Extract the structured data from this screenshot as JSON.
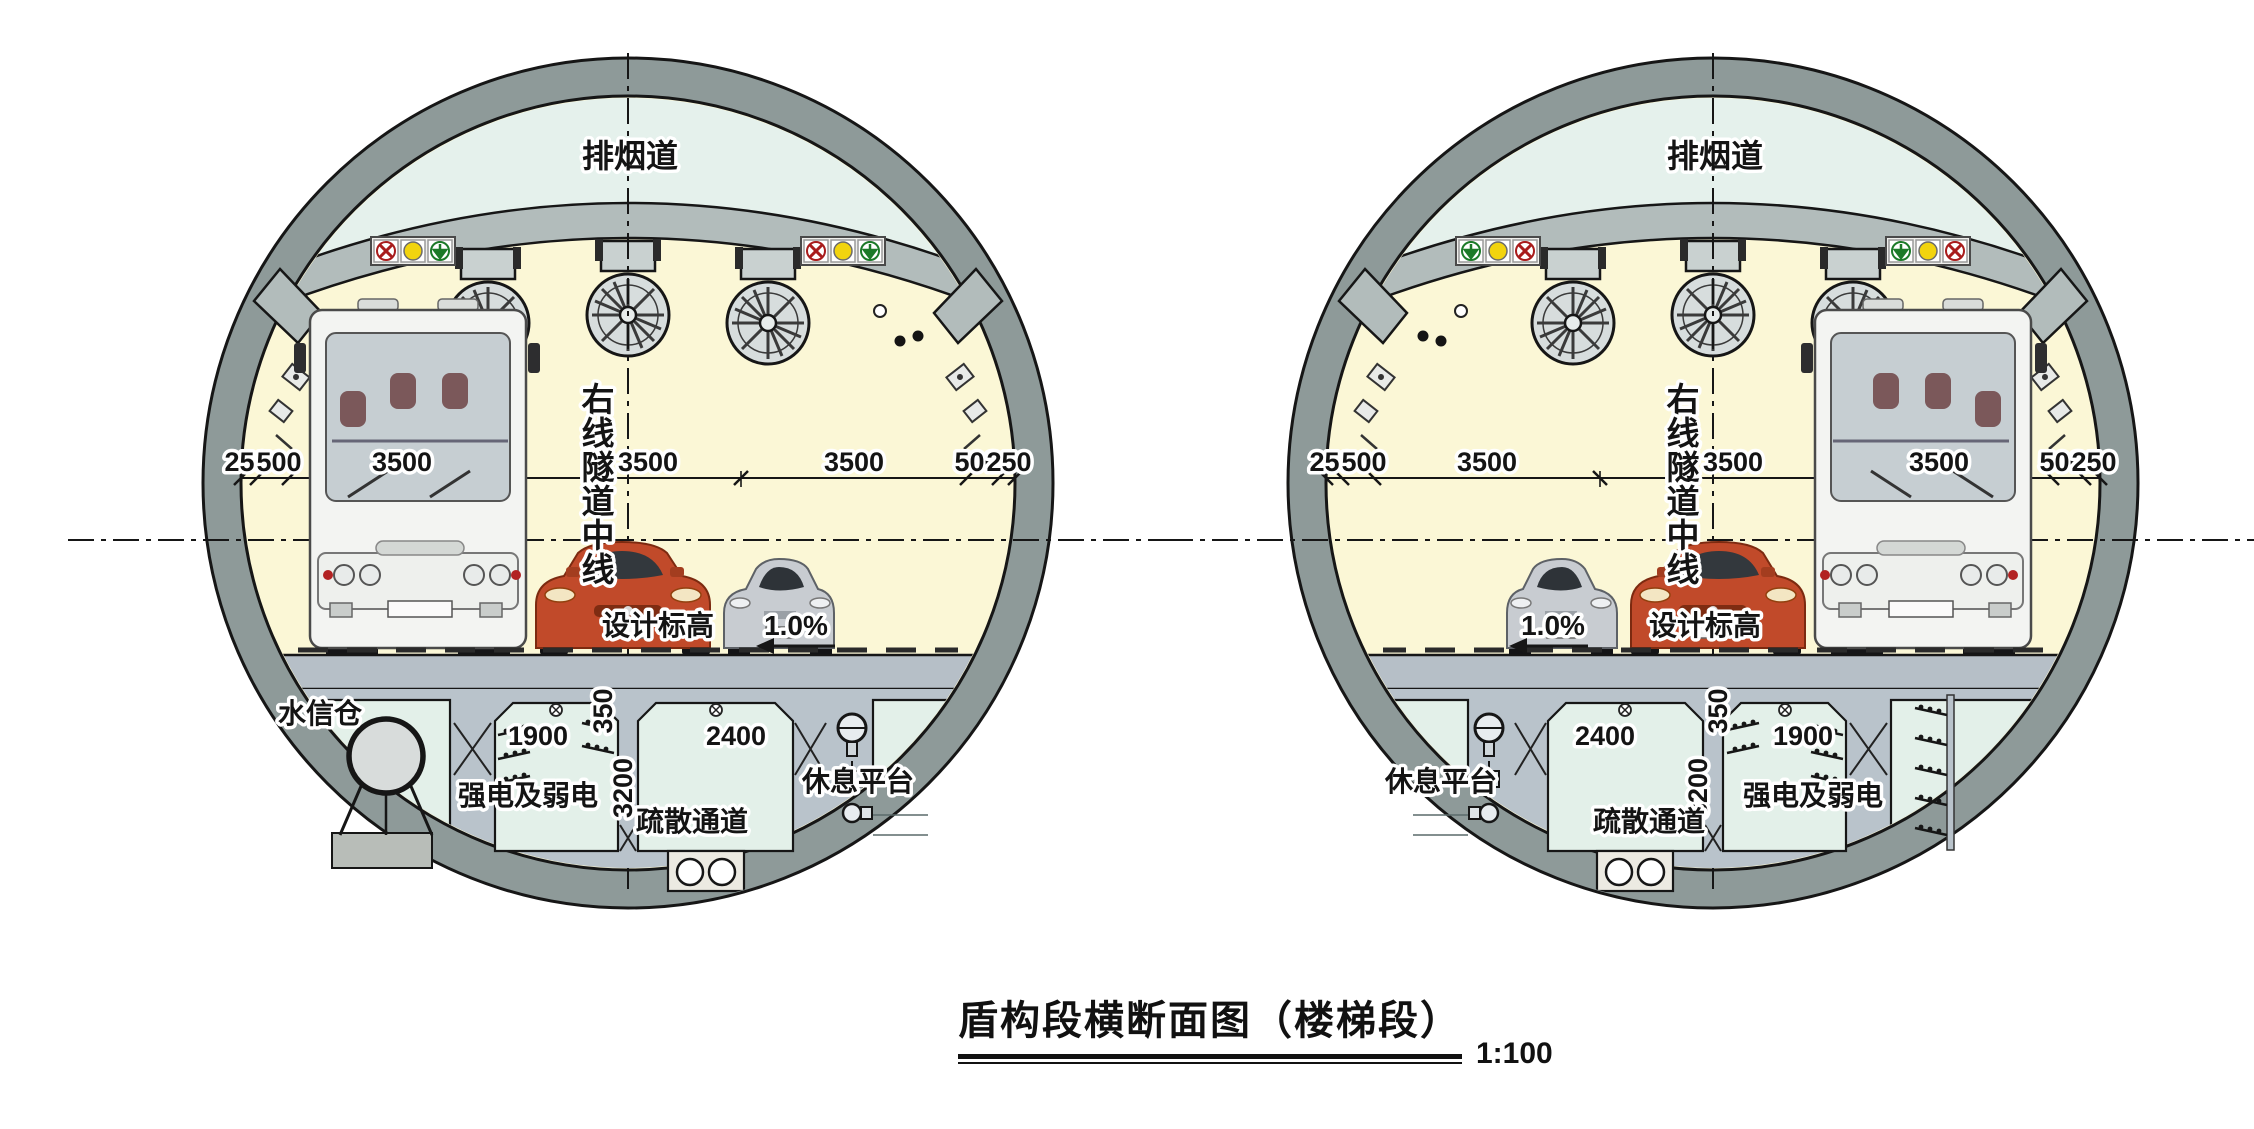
{
  "drawing": {
    "title": "盾构段横断面图（楼梯段）",
    "scale": "1:100",
    "labels": {
      "smoke_duct": "排烟道",
      "tunnel_centerline": "右线隧道中线",
      "centerline_chars": [
        "右",
        "线",
        "隧",
        "道",
        "中",
        "线"
      ],
      "design_level": "设计标高",
      "slope": "1.0%",
      "water_info_bay": "水信仓",
      "power_room": "强电及弱电",
      "evac_passage": "疏散通道",
      "rest_platform": "休息平台"
    },
    "dimensions": {
      "roadway": [
        "250",
        "500",
        "3500",
        "3500",
        "3500",
        "500",
        "250"
      ],
      "deck_thickness": "350",
      "evac_width": "2400",
      "evac_height": "3200",
      "power_width": "1900"
    },
    "colors": {
      "lining_ring": "#8e9a99",
      "line_dark": "#161616",
      "smoke_duct_fill": "#e5f1ec",
      "cavity_fill": "#fbf7d6",
      "slab_fill": "#b2bcbb",
      "structure_fill": "#b9c3cb",
      "room_fill": "#e3f0e9",
      "deck_fill": "#b6bfc7",
      "signal_red": "#a81c1c",
      "signal_yellow": "#f2d40e",
      "signal_green": "#1c7a28",
      "car_red": "#c14a2a",
      "car_silver": "#c8ccd1",
      "bus_white": "#f3f4f2"
    }
  }
}
